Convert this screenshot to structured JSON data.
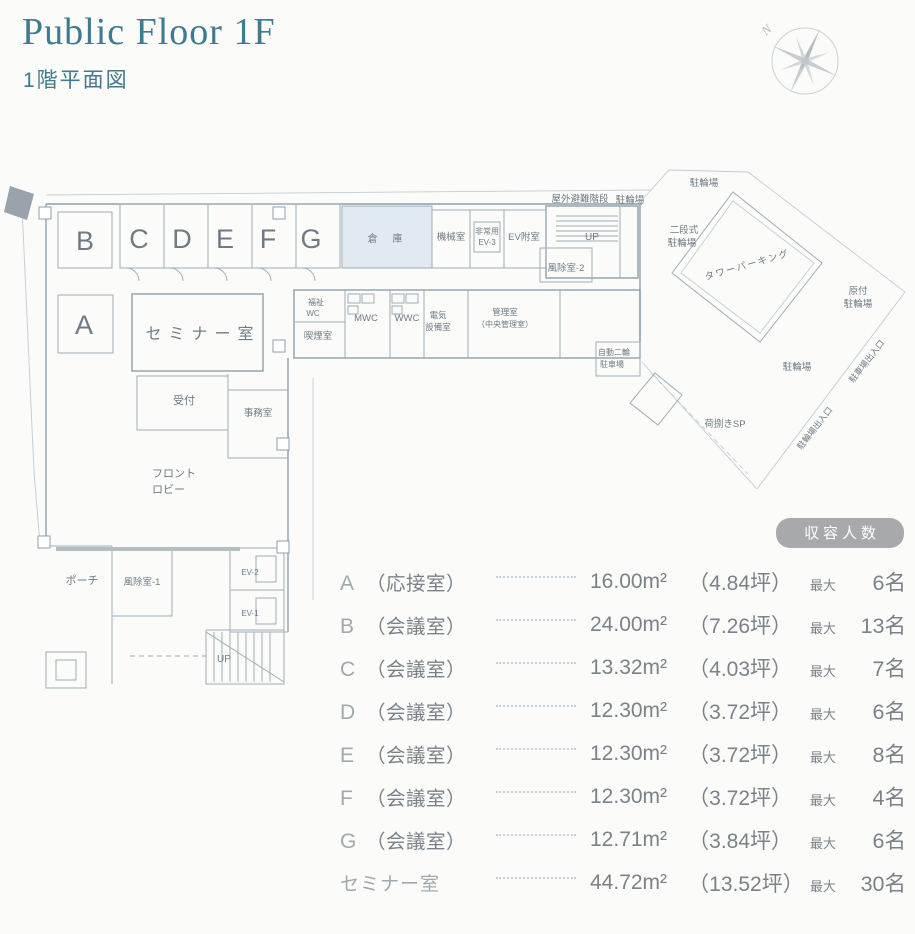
{
  "header": {
    "title": "Public Floor 1F",
    "subtitle": "1階平面図",
    "compass": "N"
  },
  "colors": {
    "accent_teal": "#3e7a90",
    "plan_line": "#9fadb7",
    "plan_text": "#6f7b84",
    "badge_bg": "#a7a9ab",
    "table_text": "#7b8287",
    "storage_fill": "#e0eaf0"
  },
  "plan": {
    "labels": {
      "room_a": "A",
      "room_b": "B",
      "room_c": "C",
      "room_d": "D",
      "room_e": "E",
      "room_f": "F",
      "room_g": "G",
      "seminar": "セミナー室",
      "storage": "倉 庫",
      "machine_room": "機械室",
      "emergency_ev_1": "非常用",
      "emergency_ev_2": "EV-3",
      "ev_lobby": "EV附室",
      "up_top": "UP",
      "outdoor_escape_stairs": "屋外避難階段",
      "bicycle_parking_stairs": "駐輪場",
      "windbreak_2": "風除室-2",
      "welfare_wc_1": "福祉",
      "welfare_wc_2": "WC",
      "smoking_room": "喫煙室",
      "mwc": "MWC",
      "wwc": "WWC",
      "electrical_1": "電気",
      "electrical_2": "設備室",
      "control_room_1": "管理室",
      "control_room_2": "（中央管理室）",
      "motorcycle_1": "自動二輪",
      "motorcycle_2": "駐車場",
      "two_tier_1": "二段式",
      "two_tier_2": "駐輪場",
      "tower_parking": "タワーパーキング",
      "moped_1": "原付",
      "moped_2": "駐輪場",
      "bicycle_parking_upper": "駐輪場",
      "bicycle_parking_lower": "駐輪場",
      "car_entrance": "駐車場出入口",
      "bicycle_entrance": "駐輪場出入口",
      "loading_space": "荷捌きSP",
      "reception": "受付",
      "office": "事務室",
      "front_lobby_1": "フロント",
      "front_lobby_2": "ロビー",
      "porch": "ポーチ",
      "windbreak_1": "風除室-1",
      "ev2": "EV-2",
      "ev1": "EV-1",
      "up_bottom": "UP"
    }
  },
  "capacity_table": {
    "badge": "収容人数",
    "rows": [
      {
        "letter": "A",
        "name": "（応接室）",
        "area": "16.00m²",
        "tsubo": "（4.84坪）",
        "max": "最大",
        "capacity": "6名"
      },
      {
        "letter": "B",
        "name": "（会議室）",
        "area": "24.00m²",
        "tsubo": "（7.26坪）",
        "max": "最大",
        "capacity": "13名"
      },
      {
        "letter": "C",
        "name": "（会議室）",
        "area": "13.32m²",
        "tsubo": "（4.03坪）",
        "max": "最大",
        "capacity": "7名"
      },
      {
        "letter": "D",
        "name": "（会議室）",
        "area": "12.30m²",
        "tsubo": "（3.72坪）",
        "max": "最大",
        "capacity": "6名"
      },
      {
        "letter": "E",
        "name": "（会議室）",
        "area": "12.30m²",
        "tsubo": "（3.72坪）",
        "max": "最大",
        "capacity": "8名"
      },
      {
        "letter": "F",
        "name": "（会議室）",
        "area": "12.30m²",
        "tsubo": "（3.72坪）",
        "max": "最大",
        "capacity": "4名"
      },
      {
        "letter": "G",
        "name": "（会議室）",
        "area": "12.71m²",
        "tsubo": "（3.84坪）",
        "max": "最大",
        "capacity": "6名"
      },
      {
        "letter": "セミナー室",
        "name": "",
        "area": "44.72m²",
        "tsubo": "（13.52坪）",
        "max": "最大",
        "capacity": "30名"
      }
    ]
  }
}
